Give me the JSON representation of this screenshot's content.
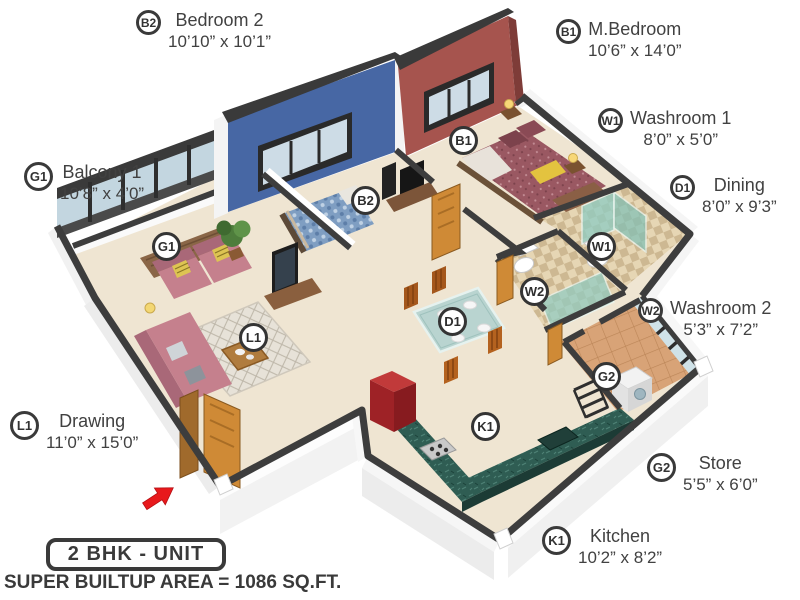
{
  "palette": {
    "wall_blue": "#4767a4",
    "wall_red": "#a6544e",
    "wall_cap_dark": "#3d3d3d",
    "floor_cream": "#efe5d2",
    "counter_green": "#2f5d53",
    "sofa_pink": "#c5808d",
    "glass_teal": "#8fccc3",
    "entrance_arrow_red": "#e8191c",
    "label_text": "#414141"
  },
  "room_labels": [
    {
      "id": "b2",
      "code": "B2",
      "name": "Bedroom 2",
      "dims": "10’10” x 10’1”"
    },
    {
      "id": "b1",
      "code": "B1",
      "name": "M.Bedroom",
      "dims": "10’6” x 14’0”"
    },
    {
      "id": "w1",
      "code": "W1",
      "name": "Washroom 1",
      "dims": "8’0” x 5’0”"
    },
    {
      "id": "d1",
      "code": "D1",
      "name": "Dining",
      "dims": "8’0” x 9’3”"
    },
    {
      "id": "w2",
      "code": "W2",
      "name": "Washroom 2",
      "dims": "5’3” x 7’2”"
    },
    {
      "id": "g2",
      "code": "G2",
      "name": "Store",
      "dims": "5’5” x 6’0”"
    },
    {
      "id": "k1",
      "code": "K1",
      "name": "Kitchen",
      "dims": "10’2” x 8’2”"
    },
    {
      "id": "g1",
      "code": "G1",
      "name": "Balcony 1",
      "dims": "10’8” x 4’0”"
    },
    {
      "id": "l1",
      "code": "L1",
      "name": "Drawing",
      "dims": "11’0” x 15’0”"
    }
  ],
  "plan_badges": {
    "g1": "G1",
    "b2": "B2",
    "b1": "B1",
    "w1": "W1",
    "w2": "W2",
    "d1": "D1",
    "l1": "L1",
    "g2": "G2",
    "k1": "K1"
  },
  "footer": {
    "unit_label": "2 BHK - UNIT",
    "area_label": "SUPER BUILTUP AREA = 1086 SQ.FT."
  }
}
